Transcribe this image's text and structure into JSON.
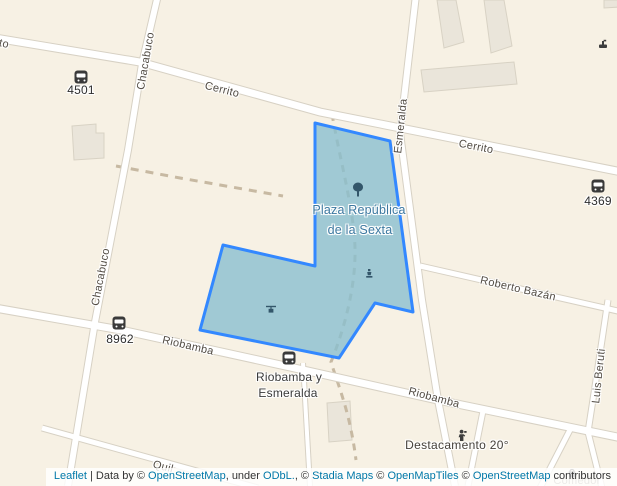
{
  "map_type": "leaflet-openstreetmap",
  "colors": {
    "background": "#f7f1e4",
    "street_fill": "#ffffff",
    "street_casing": "#d7d1c4",
    "building_fill": "#eae5da",
    "building_stroke": "#d8d2c4",
    "plaza_border": "#3388ff",
    "plaza_fill": "#89bfd0",
    "plaza_label": "#3c78a0",
    "street_label": "#514b43",
    "dashed_path": "#c7b9a2",
    "poi_dark": "#3d3d3d",
    "poi_blue": "#33566a",
    "link_blue": "#0078a8"
  },
  "street_labels": [
    {
      "id": "cerrito-west-partial",
      "text": "to"
    },
    {
      "id": "cerrito-1",
      "text": "Cerrito"
    },
    {
      "id": "cerrito-2",
      "text": "Cerrito"
    },
    {
      "id": "chacabuco-north",
      "text": "Chacabuco"
    },
    {
      "id": "chacabuco-south",
      "text": "Chacabuco"
    },
    {
      "id": "esmeralda",
      "text": "Esmeralda"
    },
    {
      "id": "roberto-bazan",
      "text": "Roberto Bazán"
    },
    {
      "id": "riobamba-west",
      "text": "Riobamba"
    },
    {
      "id": "riobamba-east",
      "text": "Riobamba"
    },
    {
      "id": "luis-beruti",
      "text": "Luis Beruti"
    },
    {
      "id": "quil-partial",
      "text": "Quil"
    }
  ],
  "stops": [
    {
      "code": "4501"
    },
    {
      "code": "4369"
    },
    {
      "code": "8962"
    },
    {
      "line1": "Riobamba y",
      "line2": "Esmeralda"
    }
  ],
  "places": {
    "plaza_line1": "Plaza República",
    "plaza_line2": "de la Sexta",
    "destacamento": "Destacamento 20°",
    "comedor": "Comedor"
  },
  "icons": [
    "bus-icon",
    "tree-icon",
    "playground-icon",
    "monument-icon",
    "fountain-icon",
    "police-icon",
    "shop-icon"
  ],
  "attribution": {
    "parts": [
      {
        "t": "Leaflet",
        "link": true
      },
      {
        "t": " | Data by © ",
        "link": false
      },
      {
        "t": "OpenStreetMap",
        "link": true
      },
      {
        "t": ", under ",
        "link": false
      },
      {
        "t": "ODbL.",
        "link": true
      },
      {
        "t": ", © ",
        "link": false
      },
      {
        "t": "Stadia Maps",
        "link": true
      },
      {
        "t": " © ",
        "link": false
      },
      {
        "t": "OpenMapTiles",
        "link": true
      },
      {
        "t": " © ",
        "link": false
      },
      {
        "t": "OpenStreetMap",
        "link": true
      },
      {
        "t": " contributors",
        "link": false
      }
    ]
  }
}
